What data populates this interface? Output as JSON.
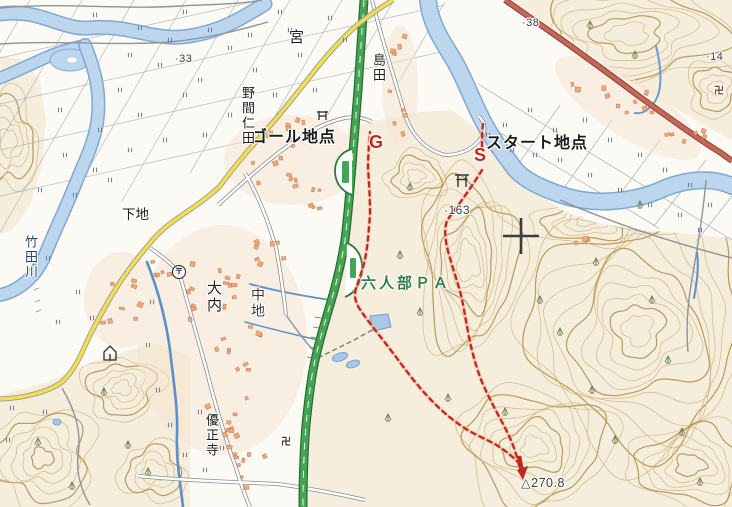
{
  "map": {
    "labels": {
      "goal_point": "ゴール地点",
      "start_point": "スタート地点",
      "goal_marker": "G",
      "start_marker": "S",
      "parking_area": "六人部ＰＡ",
      "miya": "宮",
      "shimada": "島田",
      "noma_nita": "野間仁田",
      "shimoji": "下地",
      "takeda_river": "竹田川",
      "ouchi": "大内",
      "nakaji": "中地",
      "yushoji": "優正寺",
      "elev_33": "·33",
      "elev_38": "·38",
      "elev_163": "·163",
      "elev_14": "·14",
      "summit": "△270.8",
      "post_office_mark": "〒",
      "temple_mark_sw": "卍",
      "temple_mark_ne": "卍"
    },
    "colors": {
      "expressway": "#2a7a38",
      "national_road": "#c4685a",
      "prefectural_road": "#f2df4e",
      "river": "#bcd6ee",
      "route": "#c0281e",
      "contour": "#cdb37c",
      "parking_label": "#2f7d4a"
    }
  }
}
